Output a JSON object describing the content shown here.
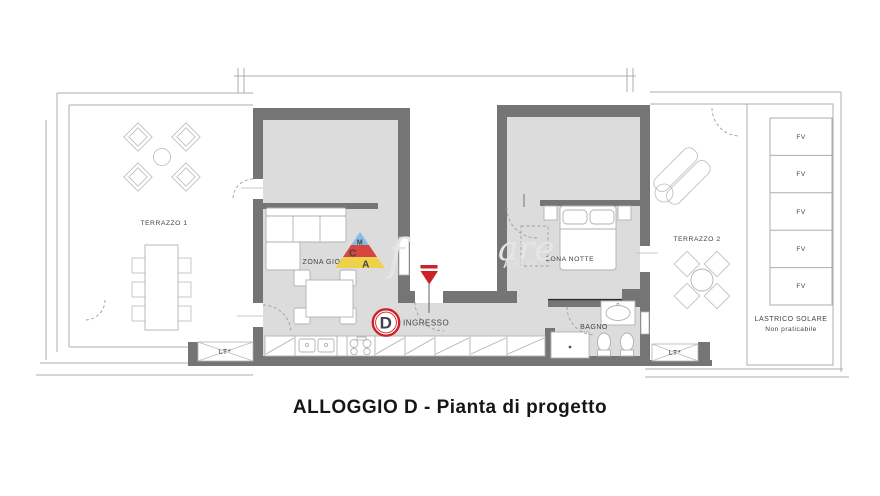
{
  "caption": "ALLOGGIO D - Pianta di progetto",
  "unit": {
    "letter": "D",
    "entrance_label": "INGRESSO"
  },
  "rooms": {
    "terrazzo1": "TERRAZZO 1",
    "zona_giorno": "ZONA GIORNO",
    "zona_notte": "ZONA NOTTE",
    "bagno": "BAGNO",
    "terrazzo2": "TERRAZZO 2",
    "lastrico_solare": "LASTRICO SOLARE",
    "lastrico_note": "Non praticabile",
    "lt_left": "LT*",
    "lt_right": "LT*"
  },
  "solar_panels": [
    "FV",
    "FV",
    "FV",
    "FV",
    "FV"
  ],
  "watermark": {
    "script_fragment_left": "f",
    "script_fragment": "are",
    "caps_fragment": "ANO",
    "logo": {
      "top_letter": "M",
      "middle_letter": "C",
      "bottom_letter": "A"
    }
  },
  "colors": {
    "wall": "#757575",
    "floor": "#dcdcdc",
    "outline": "#a9adb0",
    "accent_red": "#cc2229",
    "label_text": "#3f4449",
    "fv_text": "#4a6f66",
    "watermark_grey": "#e4e6e7",
    "logo_blue": "#85bde6",
    "logo_red": "#d6453f",
    "logo_yellow": "#efd24c",
    "logo_letter_blue": "#2f6fb8"
  }
}
